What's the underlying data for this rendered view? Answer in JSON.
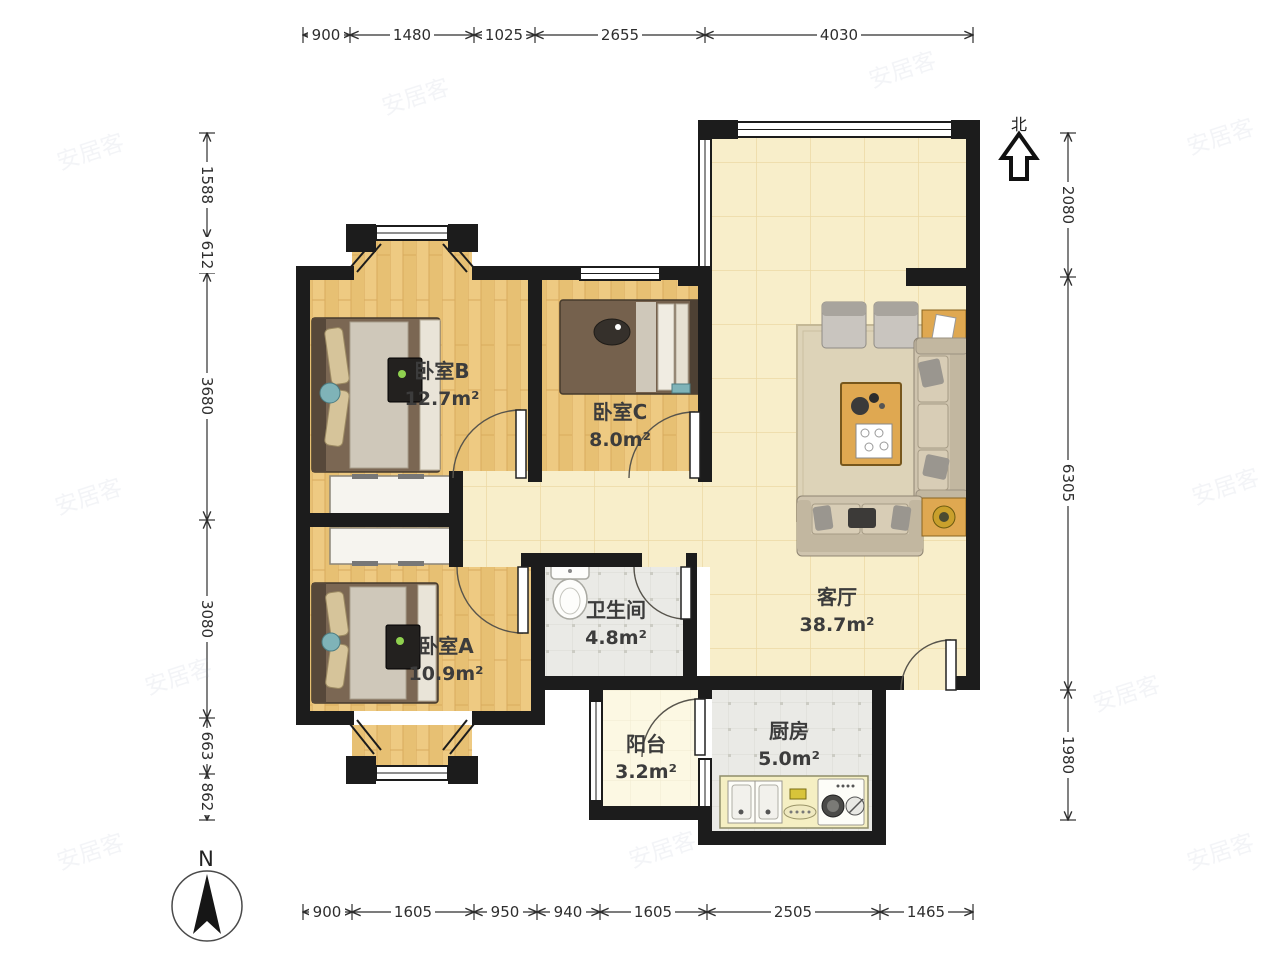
{
  "rooms": [
    {
      "name": "卧室B",
      "area": "12.7m²"
    },
    {
      "name": "卧室C",
      "area": "8.0m²"
    },
    {
      "name": "客厅",
      "area": "38.7m²"
    },
    {
      "name": "卧室A",
      "area": "10.9m²"
    },
    {
      "name": "卫生间",
      "area": "4.8m²"
    },
    {
      "name": "阳台",
      "area": "3.2m²"
    },
    {
      "name": "厨房",
      "area": "5.0m²"
    }
  ],
  "dimensions": {
    "top": [
      "900",
      "1480",
      "1025",
      "2655",
      "4030"
    ],
    "bottom": [
      "900",
      "1605",
      "950",
      "940",
      "1605",
      "2505",
      "1465"
    ],
    "left": [
      "1588",
      "612",
      "3680",
      "3080",
      "663",
      "862"
    ],
    "right": [
      "2080",
      "6305",
      "1980"
    ]
  },
  "north": {
    "label": "北"
  },
  "compass": {
    "label": "N"
  },
  "watermark": {
    "text": "安居客"
  },
  "colors": {
    "wall": "#1c1c1c",
    "wood_floor": "#eeca82",
    "tile_floor": "#f8eeca",
    "wet_floor": "#eaeae6",
    "balcony_floor": "#fcf8e3",
    "dim_text": "#2e2e2e"
  }
}
